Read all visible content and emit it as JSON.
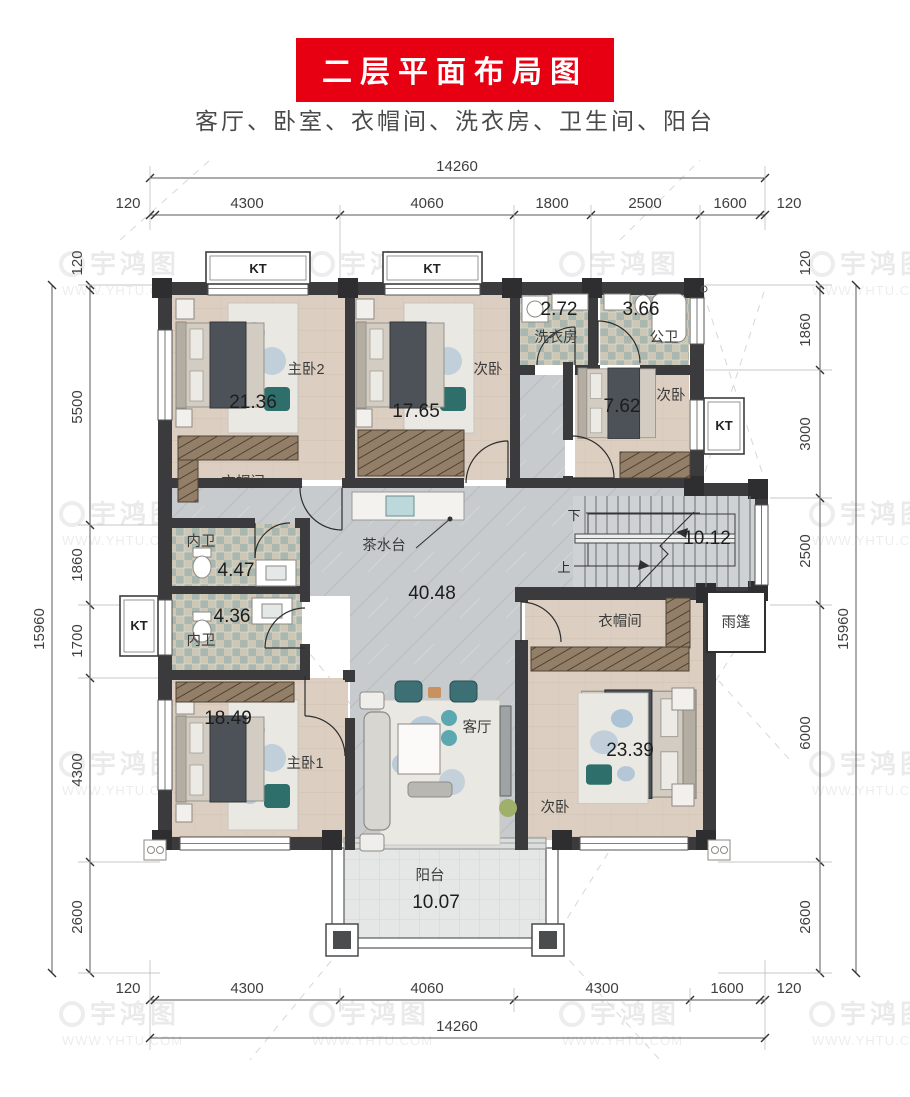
{
  "title": "二层平面布局图",
  "subtitle": "客厅、卧室、衣帽间、洗衣房、卫生间、阳台",
  "watermark": {
    "brand": "宇鸿图",
    "url": "WWW.YHTU.COM"
  },
  "kt": "KT",
  "dims": {
    "top_total": "14260",
    "top": [
      "120",
      "4300",
      "4060",
      "1800",
      "2500",
      "1600",
      "120"
    ],
    "bottom_total": "14260",
    "bottom": [
      "120",
      "4300",
      "4060",
      "4300",
      "1600",
      "120"
    ],
    "left_total": "15960",
    "left": [
      "120",
      "5500",
      "1860",
      "1700",
      "4300",
      "2600"
    ],
    "right_total": "15960",
    "right": [
      "120",
      "1860",
      "3000",
      "2500",
      "6000",
      "2600"
    ]
  },
  "rooms": {
    "master2": {
      "label": "主卧2",
      "area": "21.36"
    },
    "bed_top": {
      "label": "次卧",
      "area": "17.65"
    },
    "laundry": {
      "label": "洗衣房",
      "area": "2.72"
    },
    "pub_bath": {
      "label": "公卫",
      "area": "3.66"
    },
    "bed_right": {
      "label": "次卧",
      "area": "7.62"
    },
    "cloak_left": {
      "label": "衣帽间"
    },
    "bath_up": {
      "label": "内卫",
      "area": "4.47"
    },
    "bath_low": {
      "label": "内卫",
      "area": "4.36"
    },
    "master1": {
      "label": "主卧1",
      "area": "18.49"
    },
    "living": {
      "label": "客厅",
      "area": "40.48"
    },
    "stairs": {
      "area": "10.12",
      "down": "下",
      "up": "上"
    },
    "cloak_right": {
      "label": "衣帽间"
    },
    "canopy": {
      "label": "雨篷"
    },
    "bed_bottom": {
      "label": "次卧",
      "area": "23.39"
    },
    "balcony": {
      "label": "阳台",
      "area": "10.07"
    },
    "tea": {
      "label": "茶水台"
    }
  }
}
